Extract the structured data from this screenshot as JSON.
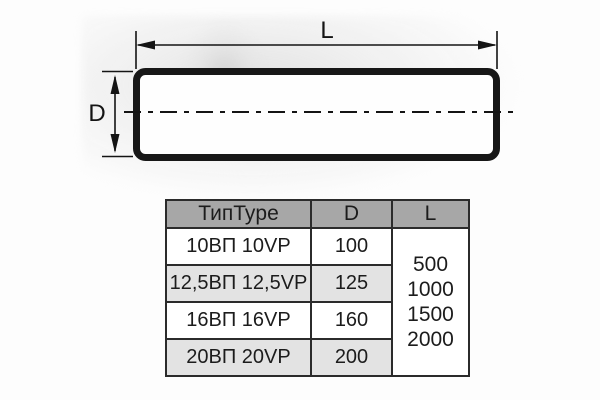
{
  "diagram": {
    "length_label": "L",
    "diameter_label": "D"
  },
  "table": {
    "headers": [
      "ТипType",
      "D",
      "L"
    ],
    "rows": [
      {
        "type": "10ВП 10VP",
        "d": "100"
      },
      {
        "type": "12,5ВП 12,5VP",
        "d": "125"
      },
      {
        "type": "16ВП 16VP",
        "d": "160"
      },
      {
        "type": "20ВП 20VP",
        "d": "200"
      }
    ],
    "l_values": [
      "500",
      "1000",
      "1500",
      "2000"
    ]
  },
  "colors": {
    "header-bg": "#a7a7a7",
    "row-alt-bg": "#e3e3e3",
    "cell-bg": "#ffffff",
    "table-border": "#2b2b2b",
    "line-color": "#141414",
    "text-color": "#1c1c1c"
  }
}
